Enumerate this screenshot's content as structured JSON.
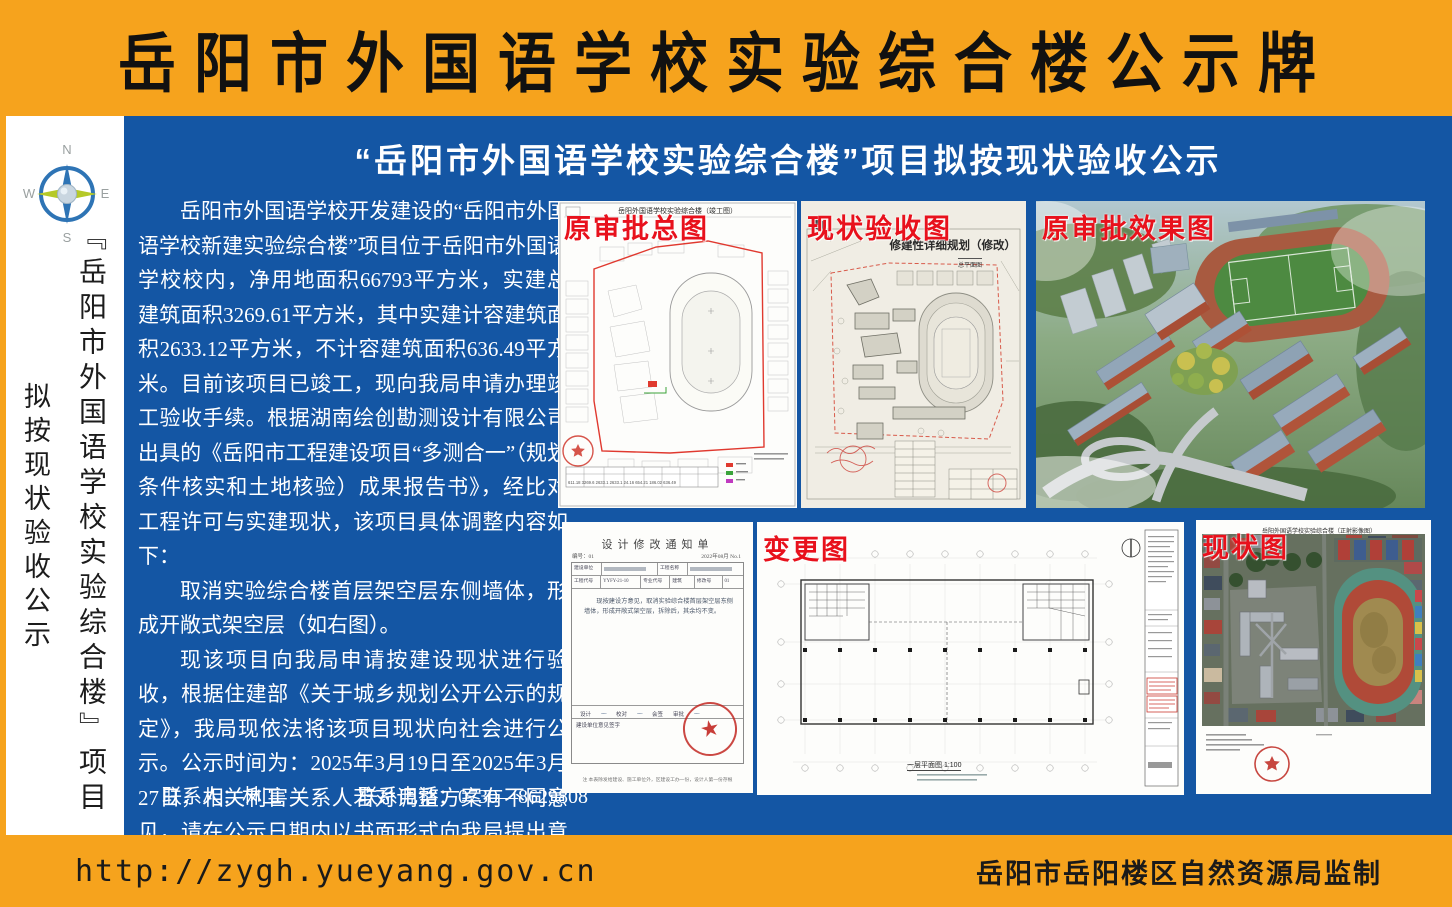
{
  "header": {
    "title": "岳阳市外国语学校实验综合楼公示牌"
  },
  "sidebar": {
    "compass": {
      "n": "N",
      "w": "W",
      "e": "E",
      "s": "S"
    },
    "project_vertical": "『岳阳市外国语学校实验综合楼』项目",
    "status_vertical": "拟按现状验收公示"
  },
  "main": {
    "title": "“岳阳市外国语学校实验综合楼”项目拟按现状验收公示",
    "paragraphs": [
      "岳阳市外国语学校开发建设的“岳阳市外国语学校新建实验综合楼”项目位于岳阳市外国语学校校内，净用地面积66793平方米，实建总建筑面积3269.61平方米，其中实建计容建筑面积2633.12平方米，不计容建筑面积636.49平方米。目前该项目已竣工，现向我局申请办理竣工验收手续。根据湖南绘创勘测设计有限公司出具的《岳阳市工程建设项目“多测合一”（规划条件核实和土地核验）成果报告书》，经比对工程许可与实建现状，该项目具体调整内容如下：",
      "取消实验综合楼首层架空层东侧墙体，形成开敞式架空层（如右图）。",
      "现该项目向我局申请按建设现状进行验收，根据住建部《关于城乡规划公开公示的规定》，我局现依法将该项目现状向社会进行公示。公示时间为：2025年3月19日至2025年3月27日，相关利害关系人若对调整方案有不同意见，请在公示日期内以书面形式向我局提出意见或建议，逾期我局不再受理。"
    ],
    "contact": {
      "person_label": "联系人：",
      "person": "林工",
      "phone_label": "联系电话：",
      "phone": "0730—8629808"
    }
  },
  "panels": {
    "approved_site_plan": {
      "label": "原审批总图",
      "drawing_title": "岳阳外国语学校实验综合楼（竣工图）",
      "table_numbers": "611.18  3269.6  2633.1  2633.1  24.16  654.21  186.02  636.49"
    },
    "acceptance_plan": {
      "label": "现状验收图",
      "drawing_title": "修建性详细规划（修改）",
      "drawing_subtitle": "总平面图"
    },
    "approved_rendering": {
      "label": "原审批效果图"
    },
    "change_notice": {
      "title": "设计修改通知单",
      "no": "编号：01",
      "date": "2022年08月  No.1",
      "f_owner": "建设单位",
      "f_project": "工程名称",
      "f_code_label": "工程代号",
      "f_code": "YYFY-21-10",
      "f_major_label": "专业代号",
      "f_major": "建筑",
      "f_rev_label": "修改号",
      "f_rev": "01",
      "body": "现按建设方意见，取消实验综合楼首层架空层东侧墙体，形成开敞式架空层，拆除后，其余均不变。",
      "sign_design": "设计",
      "sign_check": "校对",
      "sign_joint": "会签",
      "sign_approve": "审批",
      "owner_row": "建设单位意见签字",
      "note": "注 本表除发给建设、施工单位外，区建设工办一份，设计人第一份存根"
    },
    "change_plan": {
      "label": "变更图",
      "caption": "一层平面图 1:100"
    },
    "status_photo": {
      "label": "现状图",
      "drawing_title": "岳阳外国语学校实验综合楼（正射影像图）"
    }
  },
  "footer": {
    "url": "http://zygh.yueyang.gov.cn",
    "issuer": "岳阳市岳阳楼区自然资源局监制"
  },
  "colors": {
    "header_orange": "#F6A31D",
    "board_blue": "#1456A4",
    "label_red": "#E8111C"
  }
}
